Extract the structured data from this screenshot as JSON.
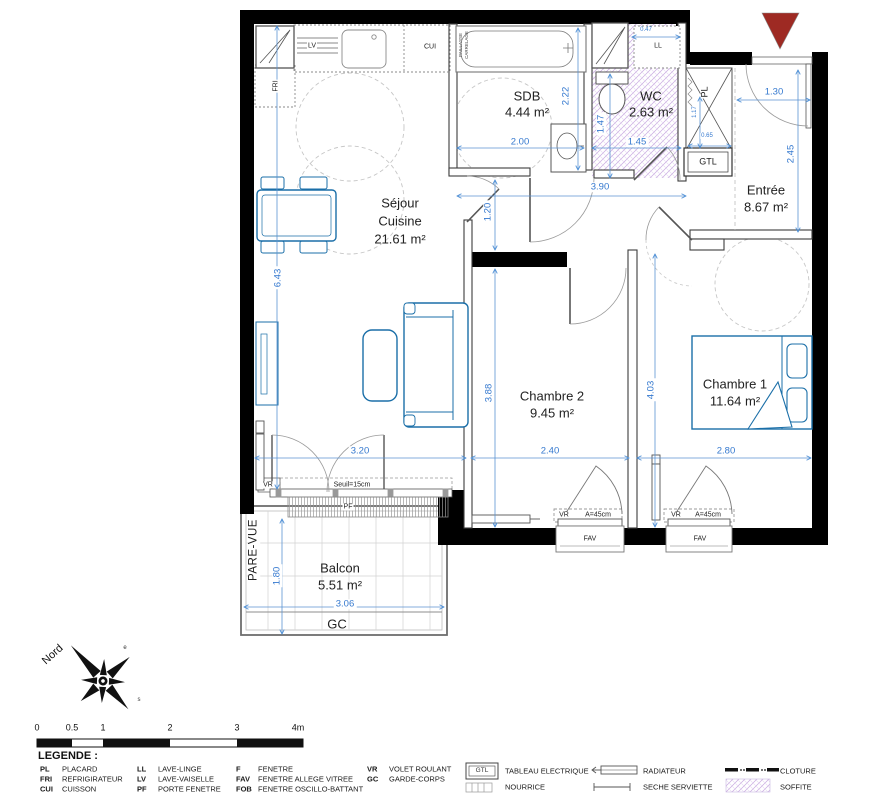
{
  "colors": {
    "wall": "#000000",
    "furniture": "#1b6fa8",
    "dimension": "#3579cf",
    "hatch": "#c9a9e0",
    "entrance_arrow": "#9e2a23"
  },
  "rooms": {
    "sejour": {
      "line1": "Séjour",
      "line2": "Cuisine",
      "area": "21.61 m²"
    },
    "sdb": {
      "label": "SDB",
      "area": "4.44 m²"
    },
    "wc": {
      "label": "WC",
      "area": "2.63 m²"
    },
    "entree": {
      "label": "Entrée",
      "area": "8.67 m²"
    },
    "chambre2": {
      "label": "Chambre 2",
      "area": "9.45 m²"
    },
    "chambre1": {
      "label": "Chambre 1",
      "area": "11.64 m²"
    },
    "balcon": {
      "label": "Balcon",
      "area": "5.51 m²"
    }
  },
  "annotations": {
    "lv": "LV",
    "cui": "CUI",
    "fri": "FRI",
    "ll": "LL",
    "pl": "PL",
    "gtl": "GTL",
    "vr": "VR",
    "pf": "PF",
    "fav": "FAV",
    "gc": "GC",
    "pare_vue": "PARE-VUE",
    "seuil": "Seuil=15cm",
    "a45": "A=45cm",
    "paillasse": "PAILLASSE",
    "carrelage": "CARRELAGE"
  },
  "dimensions": {
    "sdb_width": "2.00",
    "sdb_depth": "2.22",
    "wc_depth": "1.47",
    "wc_width": "1.45",
    "ll_width": "0.47",
    "hall_width": "3.90",
    "hall_depth": "1.20",
    "entry_door": "1.30",
    "entree_depth": "2.45",
    "pl_depth": "1.17",
    "pl_width": "0.65",
    "sejour_depth": "6.43",
    "sejour_width": "3.20",
    "ch2_width": "2.40",
    "ch2_depth": "3.88",
    "ch1_width": "2.80",
    "ch1_depth": "4.03",
    "balcon_depth": "1.80",
    "balcon_width": "3.06"
  },
  "compass": {
    "north": "Nord",
    "east": "e",
    "south": "s",
    "west": "o"
  },
  "scale_bar": {
    "ticks": [
      "0",
      "0.5",
      "1",
      "2",
      "3",
      "4m"
    ]
  },
  "legend": {
    "title": "LEGENDE :",
    "abbreviations": [
      {
        "abbr": "PL",
        "label": "PLACARD"
      },
      {
        "abbr": "FRI",
        "label": "REFRIGIRATEUR"
      },
      {
        "abbr": "CUI",
        "label": "CUISSON"
      },
      {
        "abbr": "LL",
        "label": "LAVE-LINGE"
      },
      {
        "abbr": "LV",
        "label": "LAVE-VAISELLE"
      },
      {
        "abbr": "PF",
        "label": "PORTE FENETRE"
      },
      {
        "abbr": "F",
        "label": "FENETRE"
      },
      {
        "abbr": "FAV",
        "label": "FENETRE ALLEGE VITREE"
      },
      {
        "abbr": "FOB",
        "label": "FENETRE OSCILLO-BATTANT"
      },
      {
        "abbr": "VR",
        "label": "VOLET ROULANT"
      },
      {
        "abbr": "GC",
        "label": "GARDE-CORPS"
      }
    ],
    "symbols": [
      {
        "icon": "gtl-box",
        "label": "TABLEAU ELECTRIQUE"
      },
      {
        "icon": "nourrice",
        "label": "NOURRICE"
      },
      {
        "icon": "radiator",
        "label": "RADIATEUR"
      },
      {
        "icon": "towel-dryer",
        "label": "SECHE SERVIETTE"
      },
      {
        "icon": "fence-dashes",
        "label": "CLOTURE"
      },
      {
        "icon": "soffit-hatch",
        "label": "SOFFITE"
      }
    ]
  }
}
